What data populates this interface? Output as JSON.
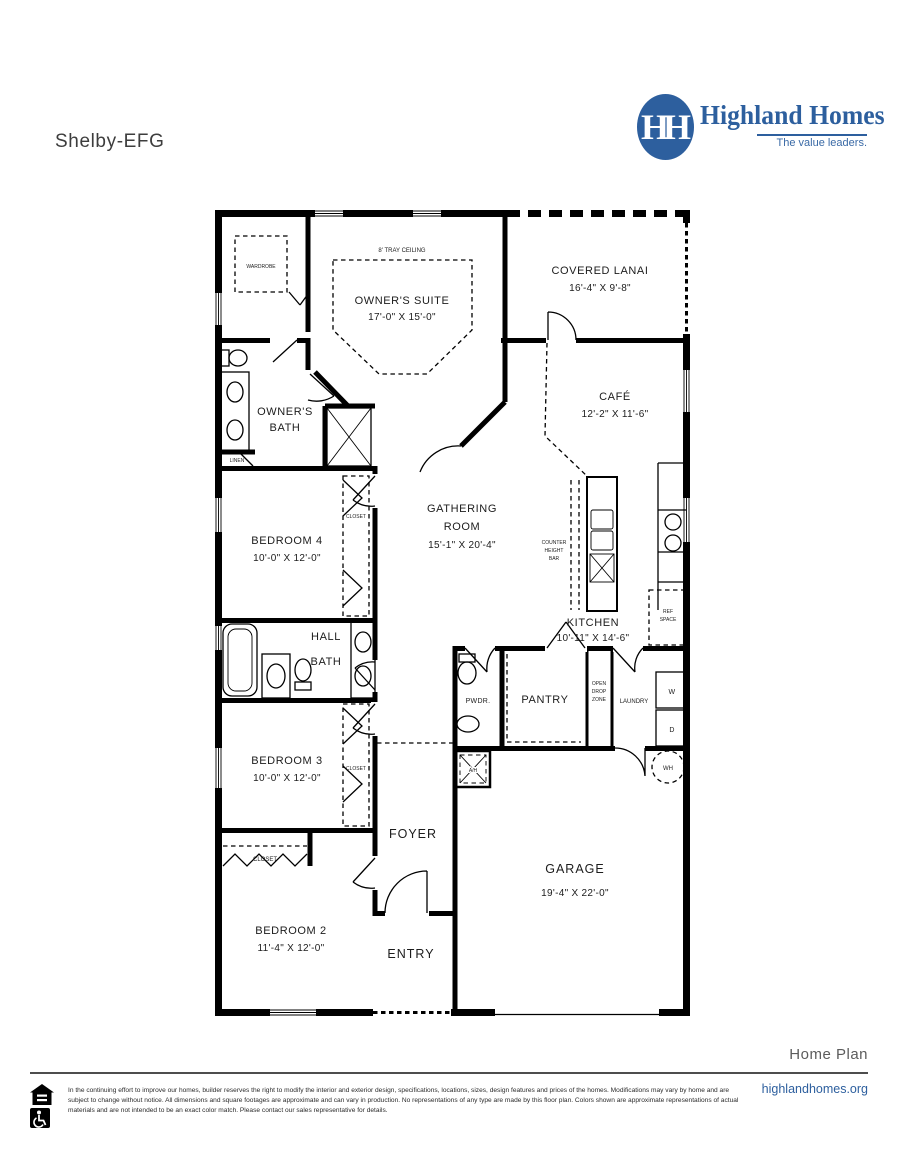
{
  "header": {
    "plan_name": "Shelby-EFG"
  },
  "brand": {
    "name": "Highland Homes",
    "tagline": "The value leaders.",
    "monogram": "HH",
    "blue": "#2d5f9e"
  },
  "rooms": {
    "owners_suite": {
      "name": "OWNER'S SUITE",
      "dims": "17'-0\" X 15'-0\""
    },
    "covered_lanai": {
      "name": "COVERED LANAI",
      "dims": "16'-4\" X 9'-8\""
    },
    "cafe": {
      "name": "CAFÉ",
      "dims": "12'-2\" X 11'-6\""
    },
    "owners_bath": {
      "line1": "OWNER'S",
      "line2": "BATH"
    },
    "gathering": {
      "line1": "GATHERING",
      "line2": "ROOM",
      "dims": "15'-1\" X 20'-4\""
    },
    "kitchen": {
      "name": "KITCHEN",
      "dims": "10'-11\" X 14'-6\""
    },
    "bedroom4": {
      "name": "BEDROOM 4",
      "dims": "10'-0\" X 12'-0\""
    },
    "hall_bath": {
      "line1": "HALL",
      "line2": "BATH"
    },
    "pwdr": {
      "name": "PWDR."
    },
    "pantry": {
      "name": "PANTRY"
    },
    "drop_zone": {
      "line1": "OPEN",
      "line2": "DROP",
      "line3": "ZONE"
    },
    "laundry": {
      "name": "LAUNDRY"
    },
    "bedroom3": {
      "name": "BEDROOM 3",
      "dims": "10'-0\" X 12'-0\""
    },
    "foyer": {
      "name": "FOYER"
    },
    "bedroom2": {
      "name": "BEDROOM 2",
      "dims": "11'-4\" X 12'-0\""
    },
    "entry": {
      "name": "ENTRY"
    },
    "garage": {
      "name": "GARAGE",
      "dims": "19'-4\" X 22'-0\""
    }
  },
  "labels": {
    "tray_ceiling": "8' TRAY CEILING",
    "wardrobe": "WARDROBE",
    "linen": "LINEN",
    "closet": "CLOSET",
    "counter_line1": "COUNTER",
    "counter_line2": "HEIGHT",
    "counter_line3": "BAR",
    "ref_line1": "REF",
    "ref_line2": "SPACE",
    "washer": "W",
    "dryer": "D",
    "water_heater": "WH",
    "air_handler": "A/H"
  },
  "footer": {
    "section_label": "Home Plan",
    "website": "highlandhomes.org",
    "disclaimer": "In the continuing effort to improve our homes, builder reserves the right to modify the interior and exterior design, specifications, locations, sizes, design features and prices of the homes. Modifications may vary by home and are subject to change without notice. All dimensions and square footages are approximate and can vary in production. No representations of any type are made by this floor plan. Colors shown are approximate representations of actual materials and are not intended to be an exact color match. Please contact our sales representative for details."
  }
}
